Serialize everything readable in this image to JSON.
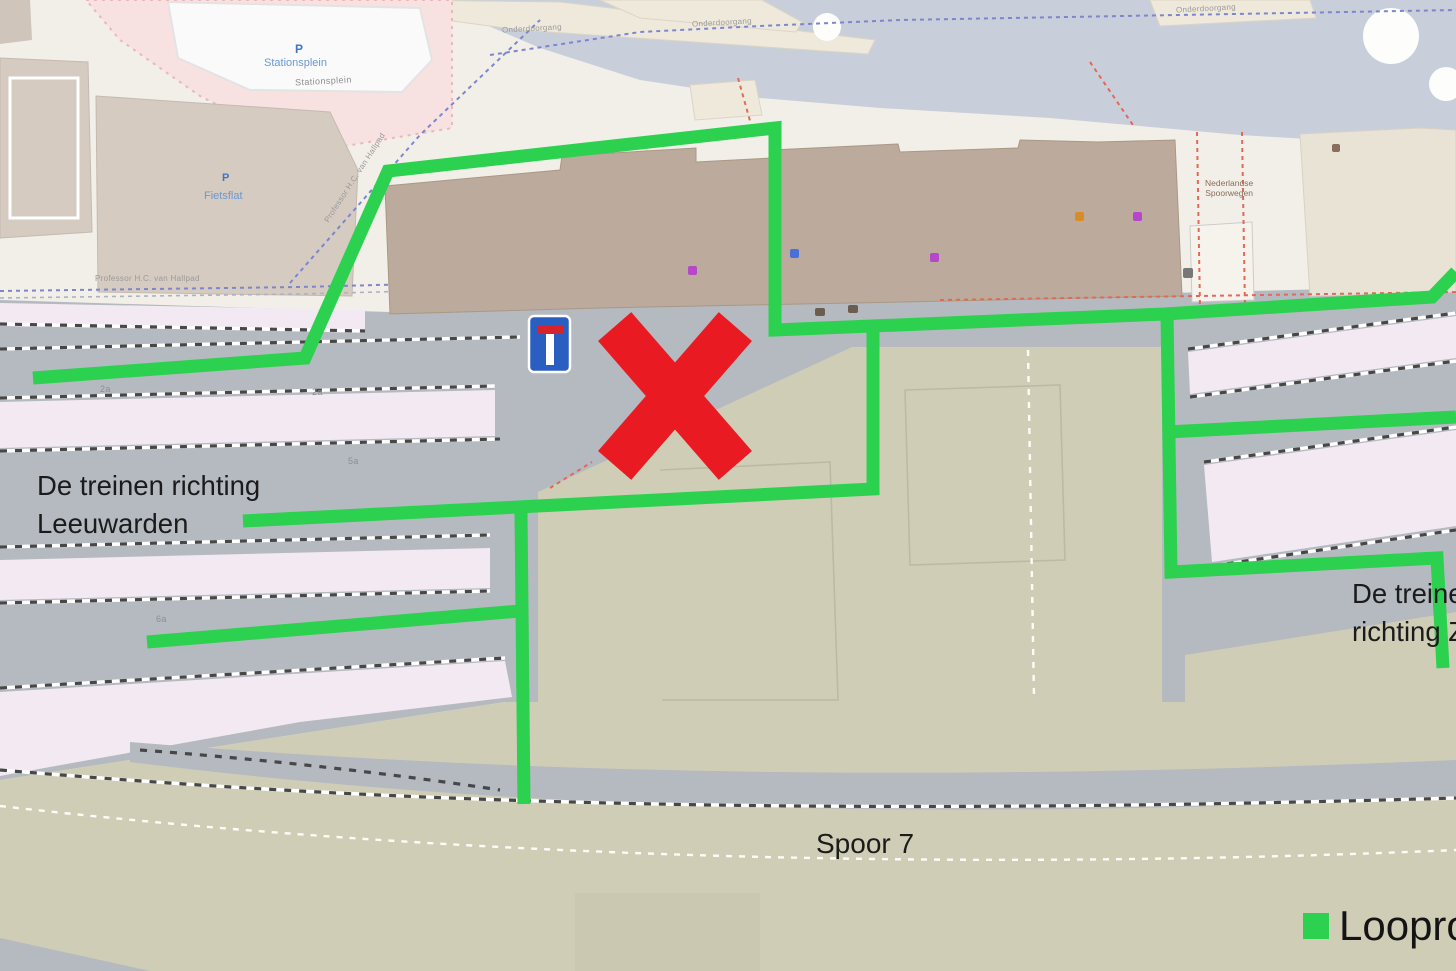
{
  "annotations": {
    "left_direction": {
      "line1": "De treinen richting",
      "line2": "Leeuwarden"
    },
    "right_direction": {
      "line1": "De treinen",
      "line2": "richting Zwolle"
    },
    "track_label": "Spoor 7"
  },
  "legend": {
    "walking_route_label": "Looproute",
    "swatch_color": "#2bd14f"
  },
  "map_labels": {
    "parking_area": "Stationsplein",
    "parking_icon": "P",
    "square_path": "Stationsplein",
    "bike_parking": "Fietsflat",
    "bike_parking_icon": "P",
    "street_hallpad": "Professor H.C. van Hallpad",
    "street_hallpad_diagonal": "Professor H.C. van Hallpad",
    "waterfront_path_1": "Onderdoorgang",
    "waterfront_path_2": "Onderdoorgang",
    "waterfront_path_3": "Onderdoorgang",
    "railway_company_line1": "Nederlandse",
    "railway_company_line2": "Spoorwegen",
    "platform_2a_west": "2a",
    "platform_2a_east": "2a",
    "platform_5a": "5a",
    "platform_6a": "6a"
  },
  "colors": {
    "route_green": "#2bd14f",
    "cross_red": "#ea1a22",
    "sign_blue": "#2a5fc1",
    "sign_red": "#d8232a",
    "water": "#c8cfdb",
    "land": "#f2efe9",
    "rail_gray": "#b5b9c0",
    "yard_khaki": "#cfcdb6",
    "platform_pink": "#f3e9f2",
    "station_brown": "#bcab9c"
  }
}
